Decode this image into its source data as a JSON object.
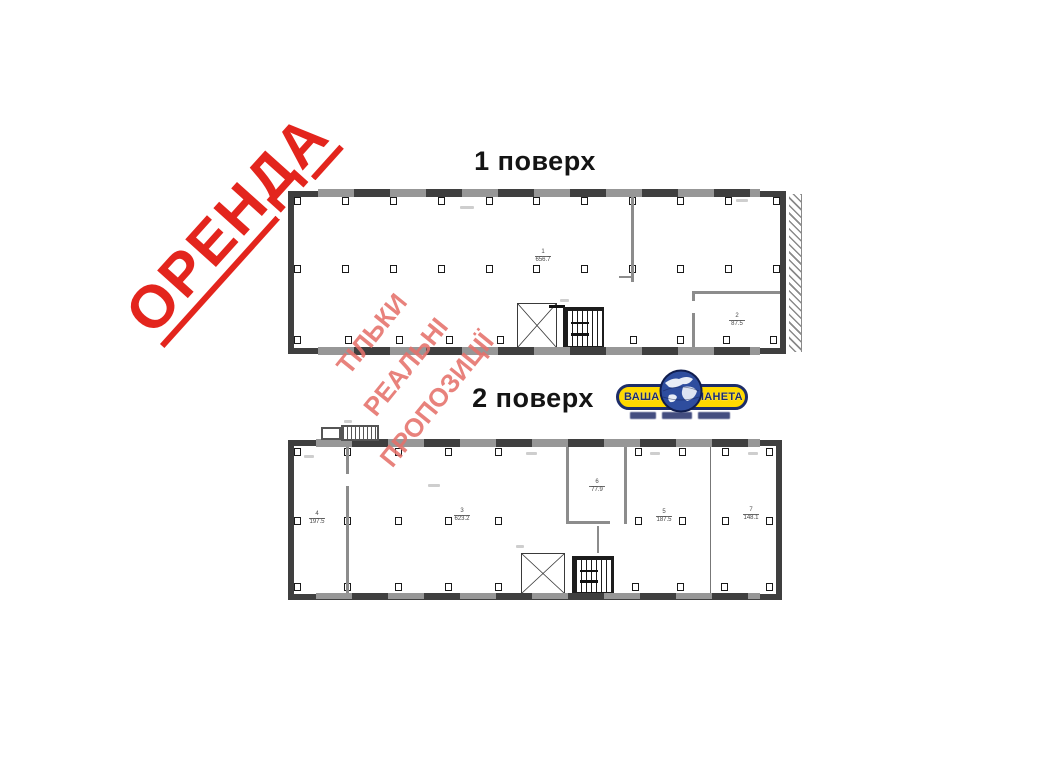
{
  "stamp": {
    "text": "ОРЕНДА",
    "color": "#e3251d"
  },
  "watermark": {
    "color": "#e5716b",
    "word1": "ТІЛЬКИ",
    "word2": "РЕАЛЬНІ",
    "word3": "ПРОПОЗИЦІЇ"
  },
  "floor1": {
    "title": "1 поверх",
    "room1": {
      "number": "1",
      "area": "656.7"
    },
    "room2": {
      "number": "2",
      "area": "87.5"
    }
  },
  "floor2": {
    "title": "2 поверх",
    "room4": {
      "number": "4",
      "area": "197.5"
    },
    "room3": {
      "number": "3",
      "area": "623.2"
    },
    "room6": {
      "number": "6",
      "area": "77.9"
    },
    "room5": {
      "number": "5",
      "area": "187.5"
    },
    "room7": {
      "number": "7",
      "area": "148.1"
    }
  },
  "logo": {
    "word_left": "ВАША",
    "word_right": "ПЛАНЕТА",
    "background": "#ffd900",
    "text_color": "#1d2d69"
  },
  "icons": {
    "logo_globe": "globe-icon",
    "elevator": "elevator-shaft-x-icon",
    "stairs": "staircase-icon"
  }
}
